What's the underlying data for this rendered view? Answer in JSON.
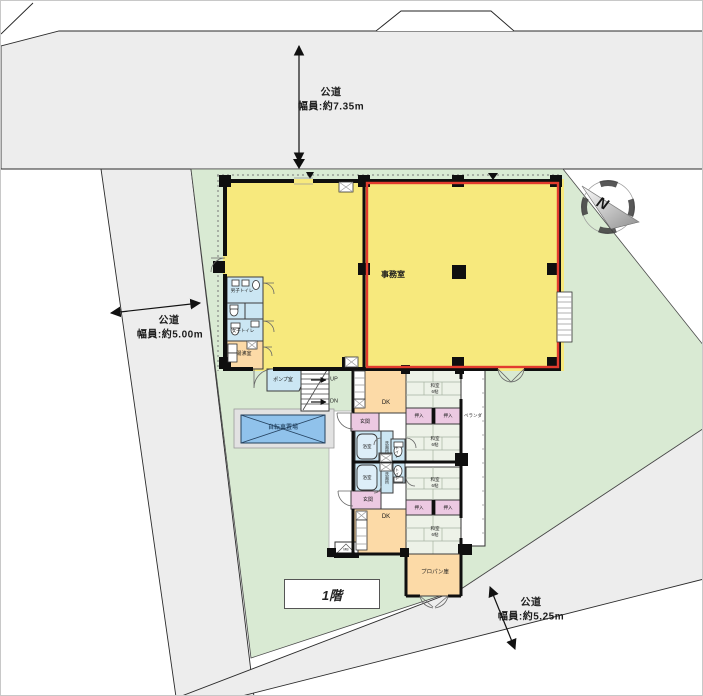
{
  "floor": {
    "label": "1階"
  },
  "roads": {
    "top": {
      "name": "公道",
      "width": "幅員:約7.35m"
    },
    "left": {
      "name": "公道",
      "width": "幅員:約5.00m"
    },
    "bottom_right": {
      "name": "公道",
      "width": "幅員:約5.25m"
    }
  },
  "compass": {
    "north_label": "N"
  },
  "rooms": {
    "office": "事務室",
    "pump_room": "ポンプ室",
    "stairs_up": "UP",
    "stairs_down": "DN",
    "bicycle_parking": "自転車置場",
    "mens_toilet": "男子トイレ",
    "womens_toilet": "女子トイレ",
    "kitchenette": "湯沸室",
    "entrance": "玄関",
    "dining_kitchen": "DK",
    "bathroom": "浴室",
    "washroom": "洗面所",
    "toilet": "トイレ",
    "closet": "押入",
    "japanese_room": "和室",
    "japanese_room_size": "6帖",
    "veranda": "ベランダ",
    "propane_storage": "プロパン庫",
    "meter_box": "MB"
  },
  "colors": {
    "road_gray": "#ededed",
    "site_green": "#d9ead3",
    "office_yellow": "#f7e97d",
    "office_outline_red": "#e23b2e",
    "water_blue": "#cbe6f3",
    "service_orange": "#fcdaa7",
    "entry_pink": "#ecc9e2",
    "tatami_green": "#edf2e8",
    "bicycle_blue": "#90c2eb"
  }
}
